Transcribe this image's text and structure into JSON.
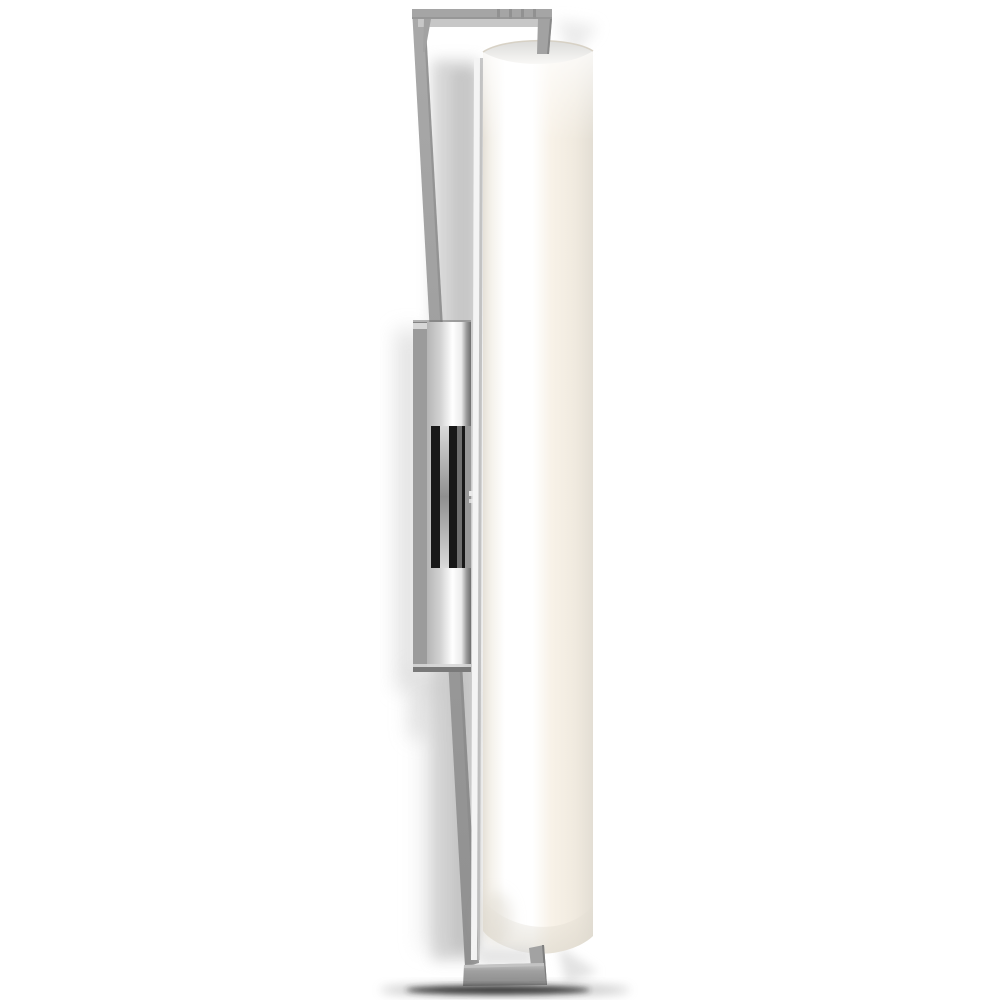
{
  "scene": {
    "type": "product-photo",
    "subject": "vertical linear wall sconce with white glass cylinder diffuser and polished nickel rectangular frame and backplate",
    "background": "#ffffff"
  },
  "colors": {
    "background": "#ffffff",
    "rail_top": "#a9a9a9",
    "rail_mid": "#9c9c9c",
    "rail_bottom": "#909090",
    "rail_edge_dark": "#868686",
    "highlight": "#f4f4f4",
    "edge_shade": "#b2b2b2",
    "bar_top_face": "#a5a5a5",
    "bar_front_edge": "#949494",
    "bar_inner_lip": "#c7c7c7",
    "bar_stripe": "#898989",
    "stub_gray": "#a2a2a2",
    "stub_edge": "#7e7e7e",
    "gap_shadow": "#c8c8c8",
    "gap_shadow_deep": "#bcbcbc",
    "wall_shadow": "#dcdcdc",
    "wall_shadow_soft": "#e9e9e9",
    "plate_side": "#9b9b9b",
    "plate_top_cap": "#d7d7d7",
    "plate_edge_dark": "#6e6e6e",
    "plate_face_a": "#b5b5b5",
    "plate_face_b": "#d2d2d2",
    "plate_face_c": "#ffffff",
    "plate_face_d": "#ececec",
    "plate_face_e": "#9a9a9a",
    "plate_bottom_edge": "#797979",
    "connector_black": "#181818",
    "connector_stripe_light": "#dadada",
    "connector_stripe_mid": "#8f8f8f",
    "connector_stripe_gray": "#707070",
    "connector_side": "#989898",
    "screw": "#eaeaea",
    "glass_edge_left": "#e6e1d8",
    "glass_near_left": "#f5f2ec",
    "glass_bright": "#ffffff",
    "glass_warm": "#f8f2e8",
    "glass_right": "#f0eadf",
    "glass_edge_right": "#e3ded4",
    "cap_top": "#dbdbd9",
    "cap_fade": "#f9f8f6",
    "cap_rim": "#d5cec1",
    "bottom_cap_shade": "#dcd7cc",
    "bottom_bar_top": "#c3c3c3",
    "bottom_bar_mid": "#a0a0a0",
    "bottom_bar_dark": "#898989",
    "contact_shadow": "#2e2e2e",
    "contact_shadow_soft": "#999999"
  }
}
